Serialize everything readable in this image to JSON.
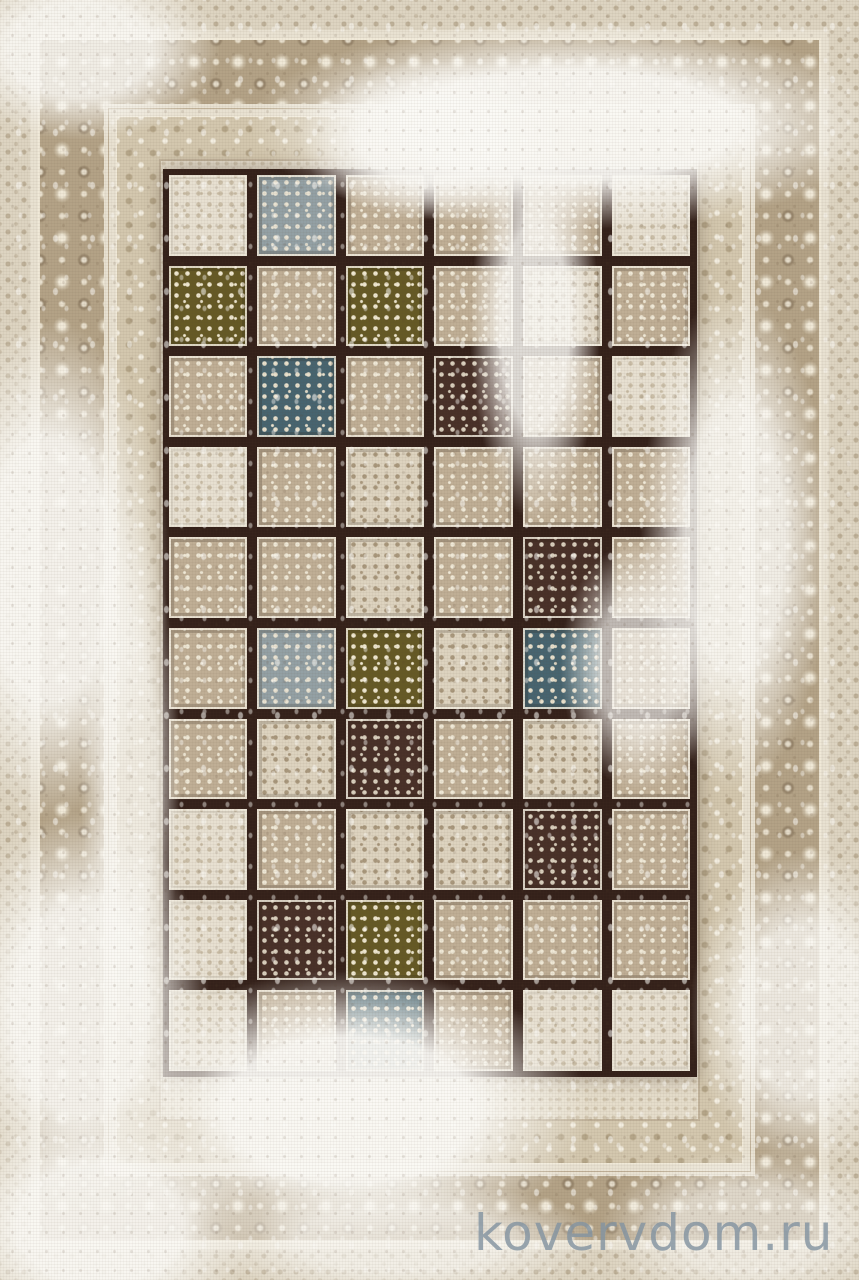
{
  "meta": {
    "subject": "Distressed vintage patchwork area rug, beige with tiled panel field — product photo",
    "width_px": 859,
    "height_px": 1280
  },
  "watermark": {
    "text": "kovervdom.ru",
    "color": "#8494a1",
    "opacity": 0.82
  },
  "palette": {
    "base_cream": "#e8e1d1",
    "field_cream": "#e5ddcb",
    "border_main": "#b3a286",
    "border_secondary": "#d3c7ae",
    "border_guard": "#ddd4c1",
    "ornament_cream": "#f0e9d8",
    "grid_line_dark": "#34211a",
    "wash_white": "#fbfaf6"
  },
  "grid": {
    "columns": 6,
    "rows": 10,
    "tile_types": {
      "b": {
        "name": "beige-floral",
        "bg": "#bfae95",
        "dot": "#efe8d6"
      },
      "c": {
        "name": "cream-ornate",
        "bg": "#ddd3bf",
        "dot": "#a8977c"
      },
      "o": {
        "name": "olive-vine",
        "bg": "#655925",
        "dot": "#eee6cf"
      },
      "n": {
        "name": "blue-diamond",
        "bg": "#47646f",
        "dot": "#e8e0cc"
      },
      "d": {
        "name": "dark-damask",
        "bg": "#483028",
        "dot": "#d9cfbd"
      },
      "g": {
        "name": "slate-floral",
        "bg": "#93a0a4",
        "dot": "#e8e2d2"
      },
      "w": {
        "name": "washed-blank",
        "bg": "#e7e0d1",
        "dot": "#c9bda6"
      }
    },
    "tiles": [
      [
        "w",
        "g",
        "b",
        "b",
        "b",
        "w"
      ],
      [
        "o",
        "b",
        "o",
        "b",
        "c",
        "b"
      ],
      [
        "b",
        "n",
        "b",
        "d",
        "b",
        "w"
      ],
      [
        "w",
        "b",
        "c",
        "b",
        "b",
        "b"
      ],
      [
        "b",
        "b",
        "c",
        "b",
        "d",
        "b"
      ],
      [
        "b",
        "g",
        "o",
        "c",
        "n",
        "b"
      ],
      [
        "b",
        "c",
        "d",
        "b",
        "c",
        "b"
      ],
      [
        "w",
        "b",
        "c",
        "c",
        "d",
        "b"
      ],
      [
        "w",
        "d",
        "o",
        "b",
        "b",
        "b"
      ],
      [
        "w",
        "b",
        "n",
        "b",
        "w",
        "w"
      ]
    ]
  },
  "wash_patches": [
    {
      "x": 250,
      "y": 20,
      "w": 640,
      "h": 210,
      "opacity": 0.95
    },
    {
      "x": 300,
      "y": 60,
      "w": 260,
      "h": 160,
      "opacity": 0.9
    },
    {
      "x": -60,
      "y": -40,
      "w": 280,
      "h": 180,
      "opacity": 0.85
    },
    {
      "x": -70,
      "y": 320,
      "w": 240,
      "h": 500,
      "opacity": 0.9
    },
    {
      "x": -50,
      "y": 810,
      "w": 260,
      "h": 400,
      "opacity": 0.9
    },
    {
      "x": 470,
      "y": 130,
      "w": 130,
      "h": 390,
      "opacity": 0.85
    },
    {
      "x": 640,
      "y": 290,
      "w": 190,
      "h": 500,
      "opacity": 0.85
    },
    {
      "x": 80,
      "y": 510,
      "w": 100,
      "h": 540,
      "opacity": 0.7
    },
    {
      "x": 560,
      "y": 540,
      "w": 160,
      "h": 250,
      "opacity": 0.7
    },
    {
      "x": 690,
      "y": 850,
      "w": 230,
      "h": 320,
      "opacity": 0.8
    },
    {
      "x": 110,
      "y": 970,
      "w": 480,
      "h": 280,
      "opacity": 0.95
    },
    {
      "x": -60,
      "y": 1110,
      "w": 320,
      "h": 230,
      "opacity": 0.9
    },
    {
      "x": 600,
      "y": 1150,
      "w": 300,
      "h": 160,
      "opacity": 0.6
    },
    {
      "x": 200,
      "y": 1180,
      "w": 400,
      "h": 120,
      "opacity": 0.7
    }
  ]
}
